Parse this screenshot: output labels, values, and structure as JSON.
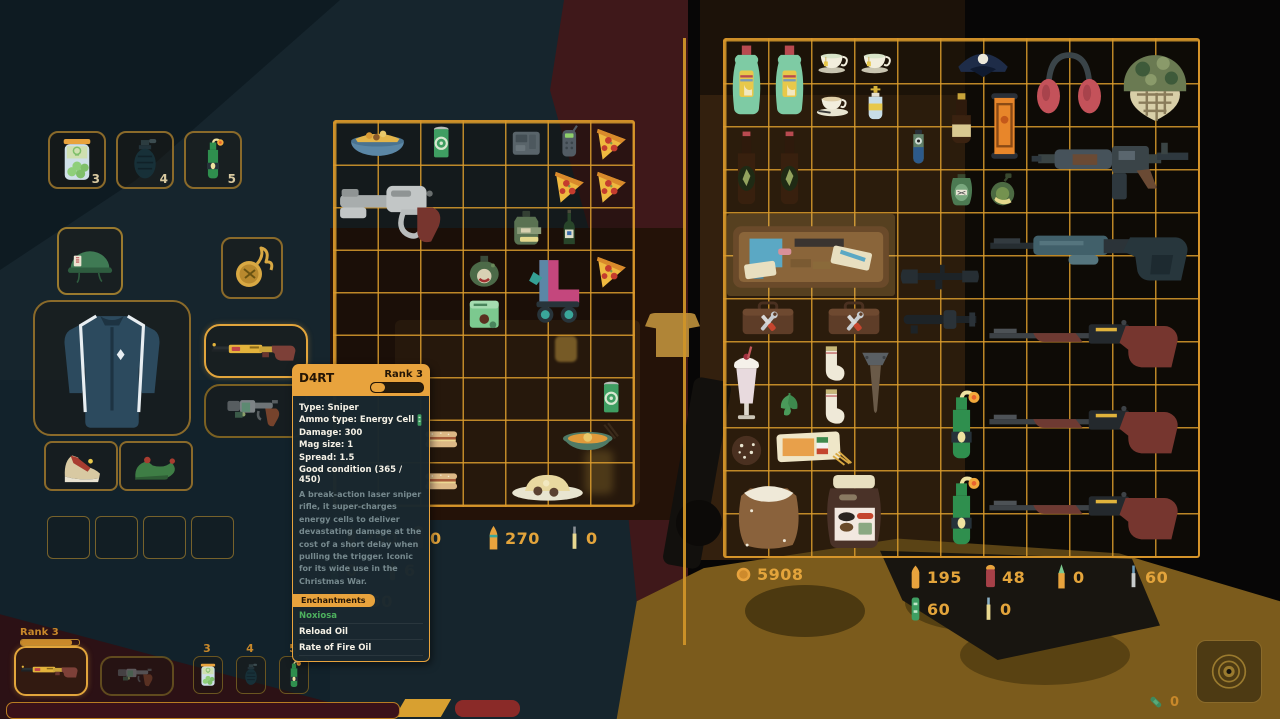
{
  "colors": {
    "accent_orange": "#d9992b",
    "count_text": "#e3a43b",
    "enchant_green": "#4db05e",
    "tooltip_header": "#e8a33d"
  },
  "tooltip": {
    "title": "D4RT",
    "rank": "Rank 3",
    "stats": [
      "Type: Sniper",
      "Ammo type: Energy Cell",
      "Damage: 300",
      "Mag size: 1",
      "Spread: 1.5",
      "Good condition (365 / 450)"
    ],
    "description": "A break-action laser sniper rifle, it super-charges energy cells to deliver devastating damage at the cost of a short delay when pulling the trigger. Iconic for its wide use in the Christmas War.",
    "enchantments_label": "Enchantments",
    "enchantments": [
      "Noxiosa",
      "Reload Oil",
      "Rate of Fire Oil"
    ]
  },
  "quick_slots": [
    {
      "name": "pickle-jar",
      "icon": "pickle-jar",
      "count": "3"
    },
    {
      "name": "grenade",
      "icon": "grenade",
      "count": "4"
    },
    {
      "name": "molotov",
      "icon": "molotov",
      "count": "5"
    }
  ],
  "equipment": {
    "head": "helmet-military",
    "trinket": "pocket-watch",
    "body": "track-jacket",
    "weapon_primary": "d4rt-rifle",
    "weapon_secondary": "revolver",
    "shoe_left": "sneaker",
    "shoe_right": "elf-shoe",
    "empty_slots": 4
  },
  "player_grid": {
    "cols": 7,
    "rows": 9,
    "items": [
      {
        "name": "bowl-of-chips",
        "icon": "chips-bowl",
        "col": 1,
        "row": 1,
        "w": 2,
        "h": 1
      },
      {
        "name": "green-can",
        "icon": "green-can",
        "col": 3,
        "row": 1,
        "w": 1,
        "h": 1
      },
      {
        "name": "gray-device",
        "icon": "gray-device",
        "col": 5,
        "row": 1,
        "w": 1,
        "h": 1
      },
      {
        "name": "detector",
        "icon": "detector",
        "col": 6,
        "row": 1,
        "w": 1,
        "h": 1
      },
      {
        "name": "pizza-slice",
        "icon": "pizza",
        "col": 7,
        "row": 1,
        "w": 1,
        "h": 1
      },
      {
        "name": "scrap-pistol",
        "icon": "gray-gun",
        "col": 1,
        "row": 2,
        "w": 3,
        "h": 2
      },
      {
        "name": "pizza-slice",
        "icon": "pizza",
        "col": 6,
        "row": 2,
        "w": 1,
        "h": 1
      },
      {
        "name": "pizza-slice",
        "icon": "pizza",
        "col": 7,
        "row": 2,
        "w": 1,
        "h": 1
      },
      {
        "name": "army-flask",
        "icon": "army-flask",
        "col": 5,
        "row": 3,
        "w": 1,
        "h": 1
      },
      {
        "name": "wine-bottle",
        "icon": "wine-bottle",
        "col": 6,
        "row": 3,
        "w": 1,
        "h": 1
      },
      {
        "name": "grog-jug",
        "icon": "grog-jug",
        "col": 4,
        "row": 4,
        "w": 1,
        "h": 1
      },
      {
        "name": "roller-skates",
        "icon": "roller-skates",
        "col": 5,
        "row": 4,
        "w": 2,
        "h": 2
      },
      {
        "name": "pizza-slice",
        "icon": "pizza",
        "col": 7,
        "row": 4,
        "w": 1,
        "h": 1
      },
      {
        "name": "ammo-box",
        "icon": "ammo-box-green",
        "col": 4,
        "row": 5,
        "w": 1,
        "h": 1
      },
      {
        "name": "green-can",
        "icon": "green-can",
        "col": 7,
        "row": 7,
        "w": 1,
        "h": 1
      },
      {
        "name": "sandwich",
        "icon": "sandwich",
        "col": 3,
        "row": 8,
        "w": 1,
        "h": 1
      },
      {
        "name": "soup-bowl",
        "icon": "soup-bowl",
        "col": 6,
        "row": 8,
        "w": 2,
        "h": 1
      },
      {
        "name": "sandwich",
        "icon": "sandwich",
        "col": 3,
        "row": 9,
        "w": 1,
        "h": 1
      },
      {
        "name": "rice-plate",
        "icon": "rice-plate",
        "col": 5,
        "row": 9,
        "w": 2,
        "h": 1
      }
    ]
  },
  "stash_grid": {
    "cols": 11,
    "rows": 12,
    "items": [
      {
        "name": "dish-soap",
        "icon": "dish-soap",
        "col": 1,
        "row": 1,
        "w": 1,
        "h": 2
      },
      {
        "name": "dish-soap",
        "icon": "dish-soap",
        "col": 2,
        "row": 1,
        "w": 1,
        "h": 2
      },
      {
        "name": "teacup",
        "icon": "teacup",
        "col": 3,
        "row": 1,
        "w": 1,
        "h": 1
      },
      {
        "name": "teacup",
        "icon": "teacup",
        "col": 4,
        "row": 1,
        "w": 1,
        "h": 1
      },
      {
        "name": "coffee-cup",
        "icon": "coffee-cup",
        "col": 3,
        "row": 2,
        "w": 1,
        "h": 1
      },
      {
        "name": "holy-water",
        "icon": "holy-water",
        "col": 4,
        "row": 2,
        "w": 1,
        "h": 1
      },
      {
        "name": "police-hat",
        "icon": "police-hat",
        "col": 6,
        "row": 1,
        "w": 2,
        "h": 1
      },
      {
        "name": "earmuffs",
        "icon": "earmuffs",
        "col": 8,
        "row": 1,
        "w": 2,
        "h": 2
      },
      {
        "name": "camo-helmet",
        "icon": "camo-helmet",
        "col": 10,
        "row": 1,
        "w": 2,
        "h": 2
      },
      {
        "name": "small-bottle",
        "icon": "small-bottle",
        "col": 6,
        "row": 2,
        "w": 1,
        "h": 2
      },
      {
        "name": "scroll-ticket",
        "icon": "scroll-ticket",
        "col": 7,
        "row": 2,
        "w": 1,
        "h": 2
      },
      {
        "name": "beer-bottle",
        "icon": "beer-bottle",
        "col": 1,
        "row": 3,
        "w": 1,
        "h": 2
      },
      {
        "name": "beer-bottle",
        "icon": "beer-bottle",
        "col": 2,
        "row": 3,
        "w": 1,
        "h": 2
      },
      {
        "name": "eye-bottle",
        "icon": "eye-bottle",
        "col": 5,
        "row": 3,
        "w": 1,
        "h": 1
      },
      {
        "name": "assault-rifle",
        "icon": "assault-rifle",
        "col": 8,
        "row": 3,
        "w": 4,
        "h": 2
      },
      {
        "name": "flask",
        "icon": "flask-label",
        "col": 6,
        "row": 4,
        "w": 1,
        "h": 1
      },
      {
        "name": "canteen",
        "icon": "canteen",
        "col": 7,
        "row": 4,
        "w": 1,
        "h": 1
      },
      {
        "name": "drill-case",
        "icon": "drill-case",
        "col": 1,
        "row": 5,
        "w": 4,
        "h": 2,
        "highlight": true
      },
      {
        "name": "scope",
        "icon": "scope",
        "col": 5,
        "row": 6,
        "w": 2,
        "h": 1
      },
      {
        "name": "lever-rifle",
        "icon": "lever-rifle",
        "col": 7,
        "row": 5,
        "w": 5,
        "h": 2
      },
      {
        "name": "toolbox",
        "icon": "toolbox",
        "col": 1,
        "row": 7,
        "w": 2,
        "h": 1
      },
      {
        "name": "toolbox",
        "icon": "toolbox",
        "col": 3,
        "row": 7,
        "w": 2,
        "h": 1
      },
      {
        "name": "suppressor",
        "icon": "suppressor",
        "col": 5,
        "row": 7,
        "w": 2,
        "h": 1
      },
      {
        "name": "hunting-rifle",
        "icon": "red-rifle",
        "col": 7,
        "row": 7,
        "w": 5,
        "h": 2
      },
      {
        "name": "milkshake",
        "icon": "milkshake",
        "col": 1,
        "row": 8,
        "w": 1,
        "h": 2
      },
      {
        "name": "sock",
        "icon": "sock",
        "col": 3,
        "row": 8,
        "w": 1,
        "h": 1
      },
      {
        "name": "spike",
        "icon": "spike",
        "col": 4,
        "row": 8,
        "w": 1,
        "h": 2
      },
      {
        "name": "mint-leaf",
        "icon": "mint-leaf",
        "col": 2,
        "row": 9,
        "w": 1,
        "h": 1
      },
      {
        "name": "sock",
        "icon": "sock",
        "col": 3,
        "row": 9,
        "w": 1,
        "h": 1
      },
      {
        "name": "molotov",
        "icon": "molotov",
        "col": 6,
        "row": 9,
        "w": 1,
        "h": 2
      },
      {
        "name": "hunting-rifle",
        "icon": "red-rifle",
        "col": 7,
        "row": 9,
        "w": 5,
        "h": 2
      },
      {
        "name": "cookie",
        "icon": "cookie",
        "col": 1,
        "row": 10,
        "w": 1,
        "h": 1
      },
      {
        "name": "pasta-pack",
        "icon": "pasta",
        "col": 2,
        "row": 10,
        "w": 2,
        "h": 1
      },
      {
        "name": "flour-sack",
        "icon": "flour-sack",
        "col": 1,
        "row": 11,
        "w": 2,
        "h": 2
      },
      {
        "name": "choco-jar",
        "icon": "choco-jar",
        "col": 3,
        "row": 11,
        "w": 2,
        "h": 2
      },
      {
        "name": "molotov",
        "icon": "molotov",
        "col": 6,
        "row": 11,
        "w": 1,
        "h": 2
      },
      {
        "name": "hunting-rifle",
        "icon": "red-rifle",
        "col": 7,
        "row": 11,
        "w": 5,
        "h": 2
      }
    ]
  },
  "player_money": "250",
  "player_ammo": [
    [
      {
        "icon": "bullet-pistol",
        "count": "250"
      },
      {
        "icon": "shell-red",
        "count": "0"
      },
      {
        "icon": "bullet-rifle",
        "count": "270"
      },
      {
        "icon": "bullet-thin",
        "count": "0"
      }
    ],
    [
      {
        "icon": "cell-green",
        "count": "0"
      },
      {
        "icon": "bullet-small-orange",
        "count": "6"
      }
    ]
  ],
  "stash_money": "5908",
  "stash_ammo": [
    [
      {
        "icon": "bullet-pistol",
        "count": "195"
      },
      {
        "icon": "shell-red",
        "count": "48"
      },
      {
        "icon": "bullet-rifle-pointed",
        "count": "0"
      },
      {
        "icon": "bullet-thin-blue",
        "count": "60"
      }
    ],
    [
      {
        "icon": "cell-green",
        "count": "60"
      },
      {
        "icon": "bullet-thin-gray",
        "count": "0"
      }
    ]
  ],
  "hotbar": {
    "rank_label": "Rank 3",
    "primary_icon": "d4rt-rifle",
    "secondary_icon": "revolver",
    "slots": [
      {
        "key": "3",
        "icon": "pickle-jar"
      },
      {
        "key": "4",
        "icon": "grenade"
      },
      {
        "key": "5",
        "icon": "molotov"
      }
    ]
  },
  "corner": {
    "bandage_count": "0"
  }
}
